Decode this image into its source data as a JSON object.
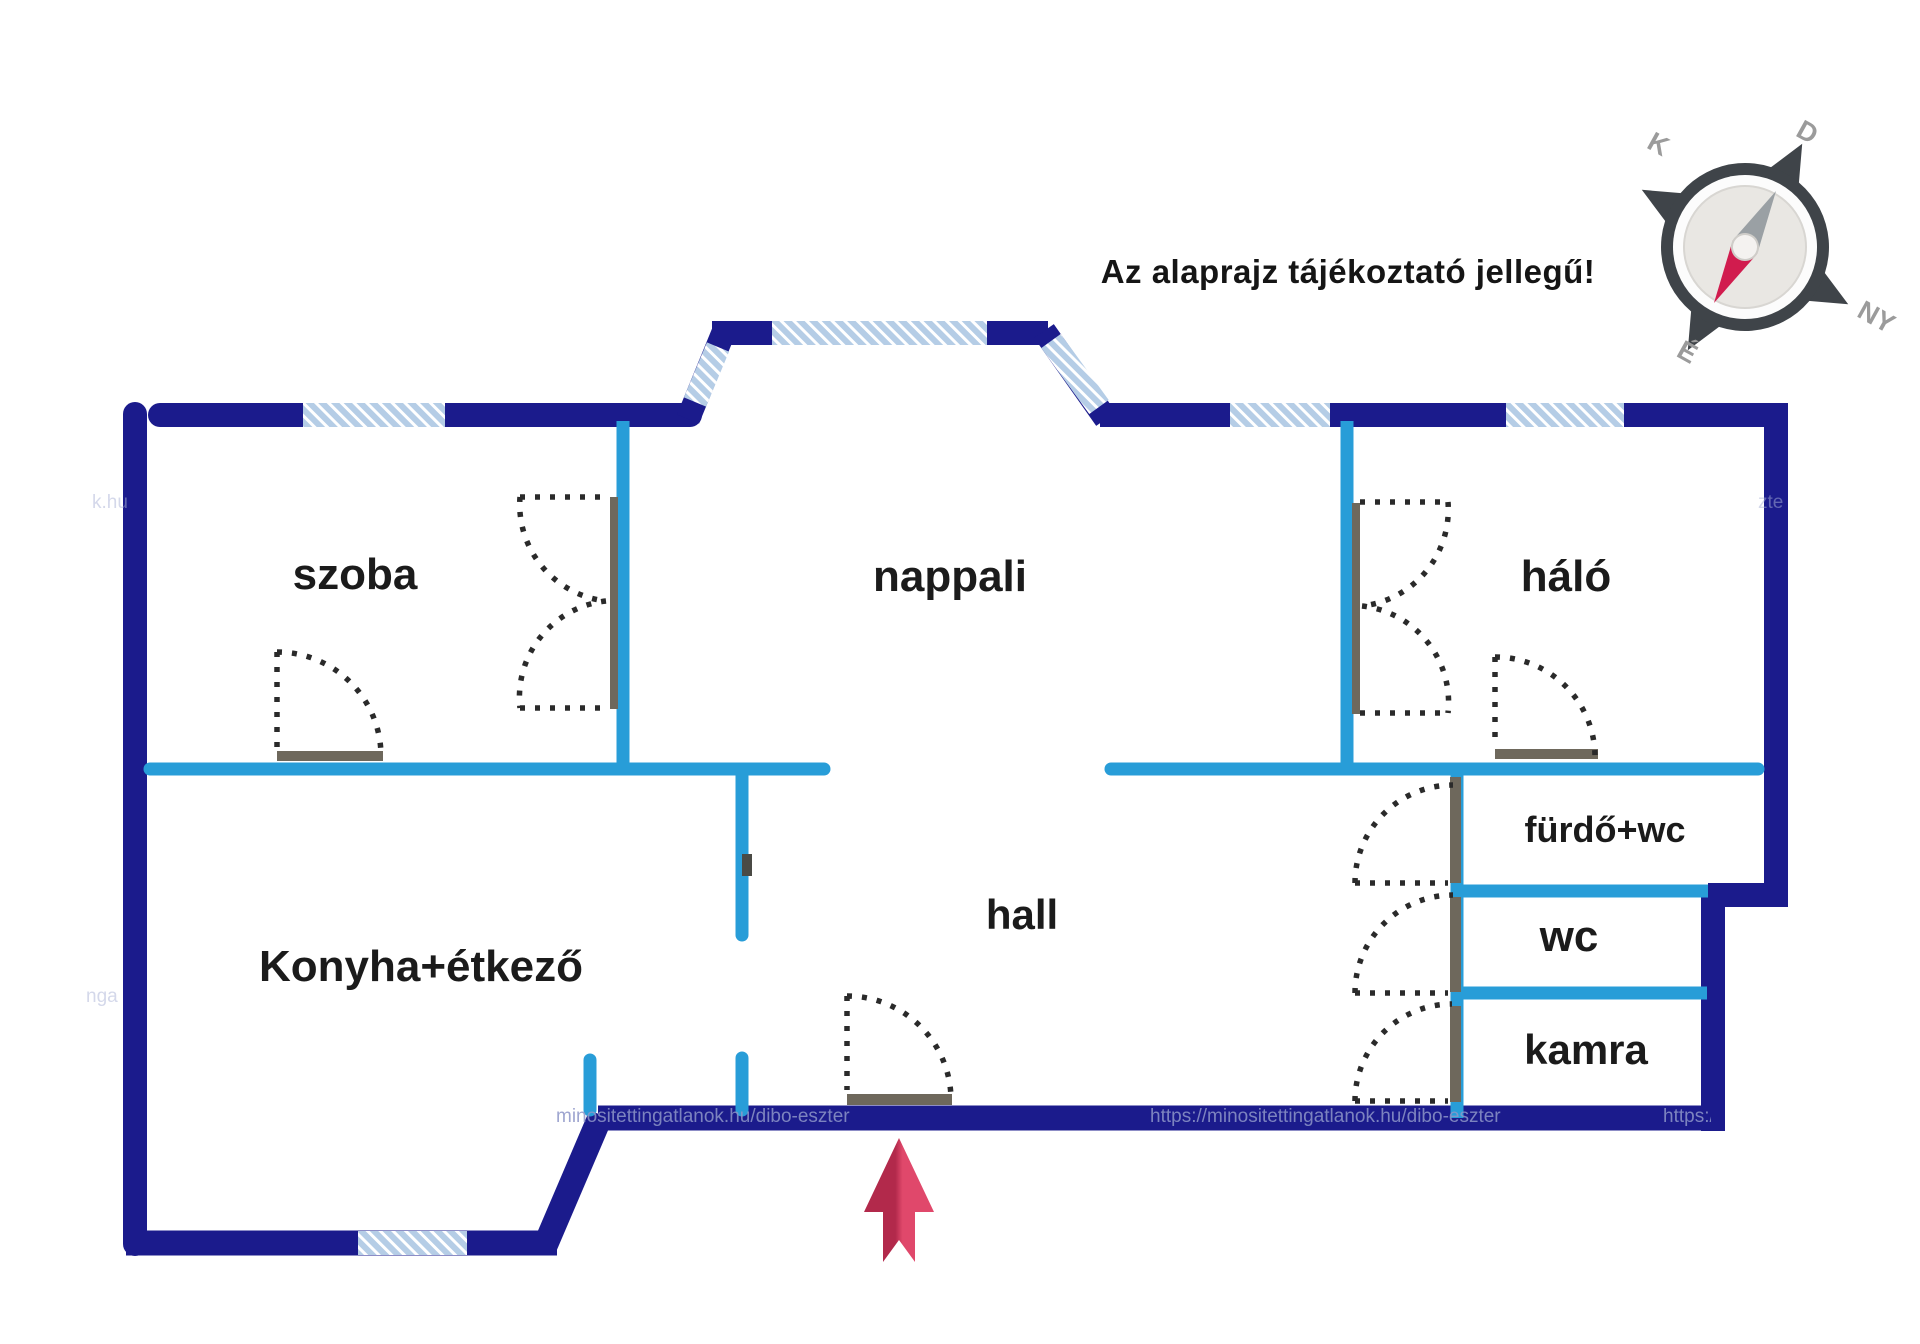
{
  "disclaimer": "Az alaprajz tájékoztató jellegű!",
  "rooms": {
    "szoba": "szoba",
    "nappali": "nappali",
    "halo": "háló",
    "konyha": "Konyha+étkező",
    "hall": "hall",
    "furdo": "fürdő+wc",
    "wc": "wc",
    "kamra": "kamra"
  },
  "compass": {
    "south": "D",
    "west": "NY",
    "north": "É",
    "east": "K"
  },
  "watermark": {
    "w1": "minositettingatlanok.hu/dibo-eszter",
    "w2": "https://minositettingatlanok.hu/dibo-eszter",
    "w3": "https://minositet",
    "f1": "k.hu",
    "f2": "nga",
    "f3": "zte"
  },
  "colors": {
    "wall": "#1b1b8c",
    "partition": "#289dd8",
    "windowBase": "#b5cde6",
    "windowStripe": "#ffffff",
    "doorLeaf": "#6e685c",
    "doorNotch": "#4a4a45",
    "dash": "#2a2a2a",
    "arrowDark": "#b2294b",
    "arrowLight": "#e0486b",
    "compassDark": "#3f4449",
    "compassFace": "#e9e7e3",
    "compassRing": "#fcfcfc",
    "needleGray": "#9aa0a4",
    "needleRed": "#d11c4e",
    "letterGray": "#9b9b9b",
    "labelText": "#1b1b1b",
    "watermark": "#8e96c8"
  }
}
